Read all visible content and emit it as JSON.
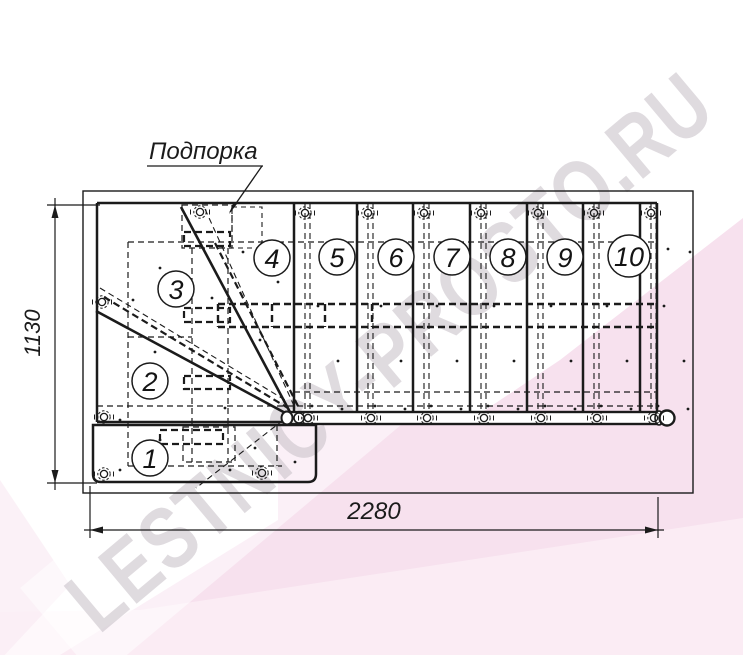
{
  "watermark": {
    "text": "LESTNICY-PROSTO.RU",
    "text_color": "#cfc8cf",
    "pink_main": "#f7e1ee",
    "pink_light": "#fdf4f9"
  },
  "drawing": {
    "support_label": "Подпорка",
    "height_dimension": "1130",
    "width_dimension": "2280",
    "steps": [
      "1",
      "2",
      "3",
      "4",
      "5",
      "6",
      "7",
      "8",
      "9",
      "10"
    ],
    "line_color": "#1b1b1b"
  }
}
